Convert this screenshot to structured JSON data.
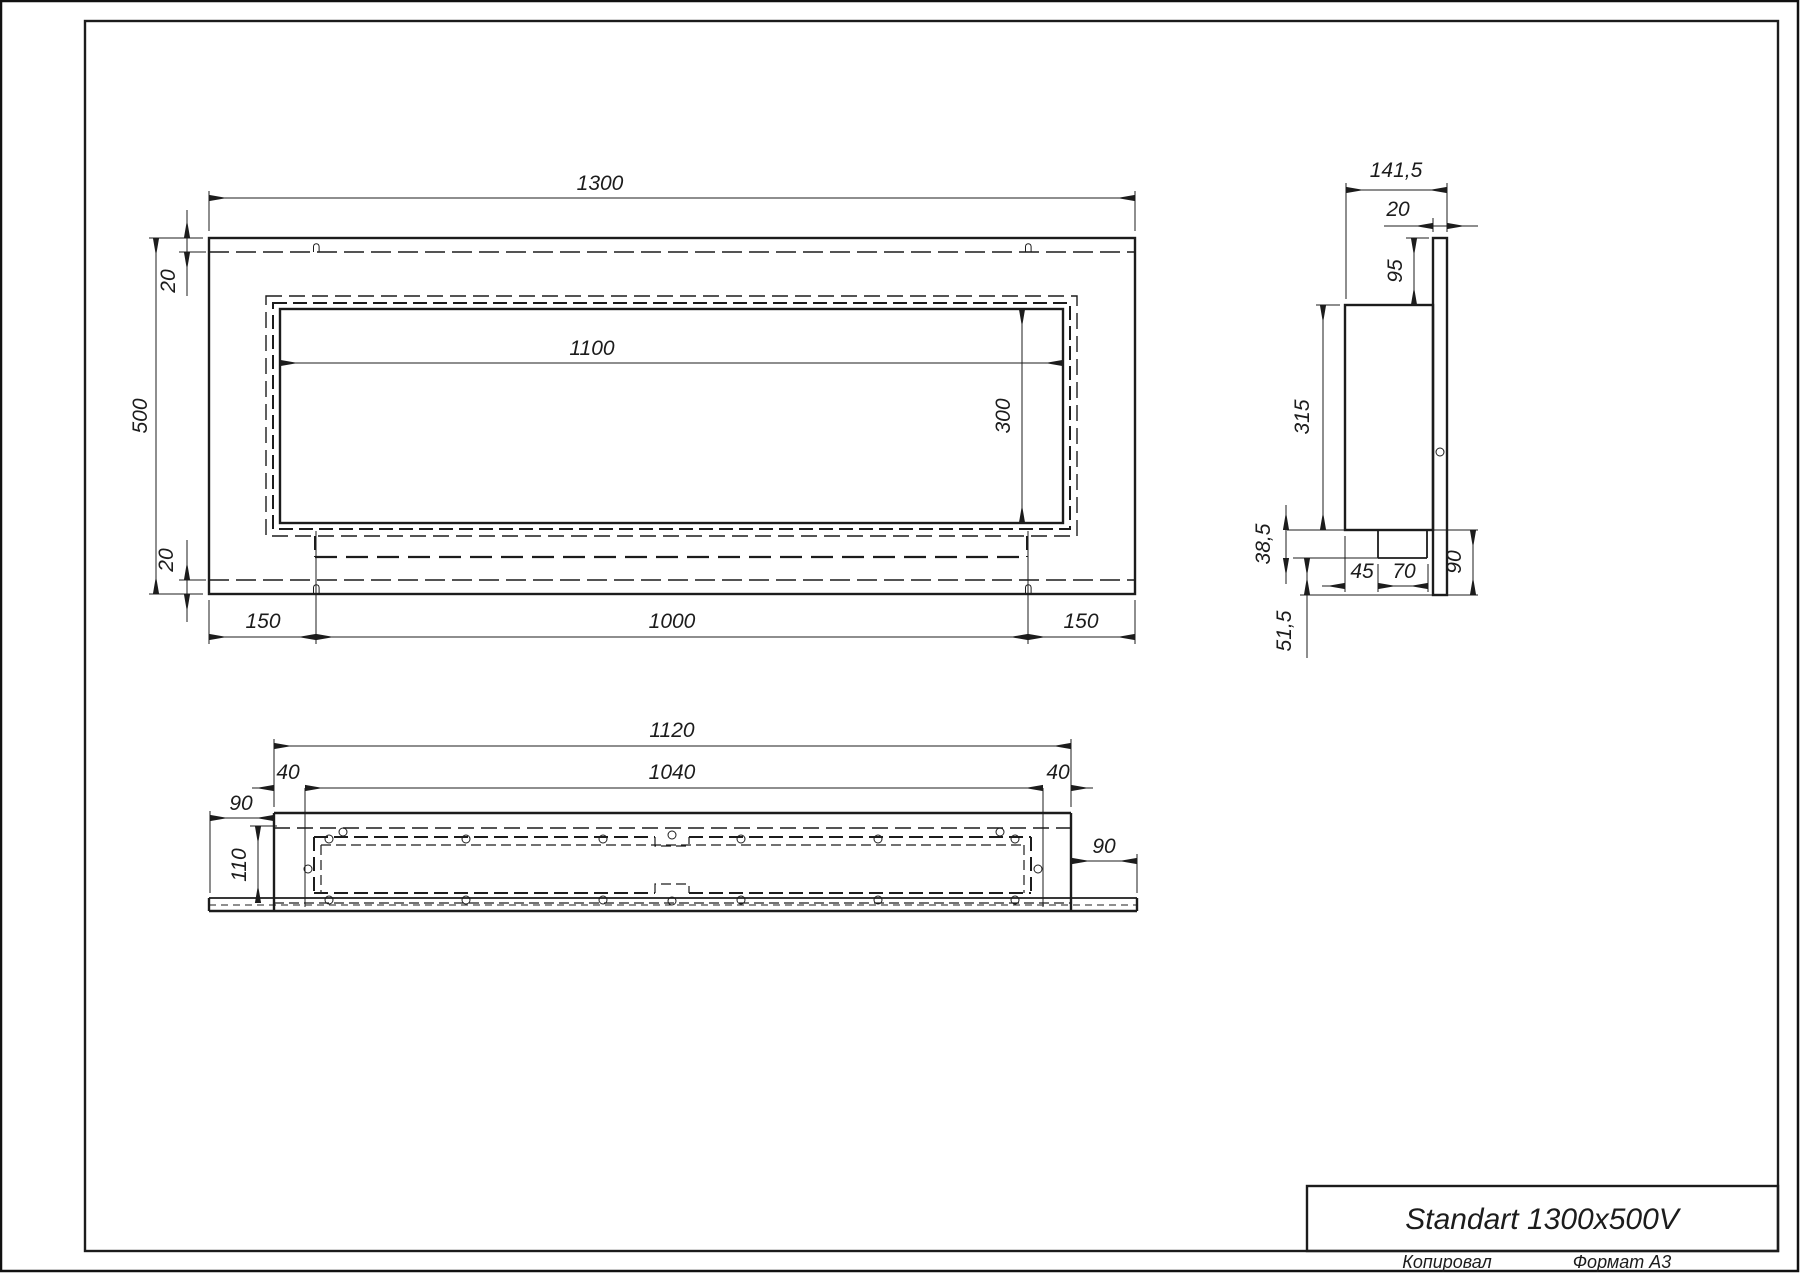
{
  "document": {
    "type": "technical-drawing",
    "product": "Standart 1300x500V",
    "sheet_format": "А3"
  },
  "title_block": {
    "title": "Standart 1300x500V",
    "footer_left": "Копировал",
    "footer_right": "Формат А3"
  },
  "views": {
    "front": {
      "label": "front-view",
      "dims": {
        "total_width": "1300",
        "total_height": "500",
        "top_inset": "20",
        "bottom_inset": "20",
        "opening_width": "1100",
        "opening_height": "300",
        "left_margin": "150",
        "box_span": "1000",
        "right_margin": "150"
      }
    },
    "side": {
      "label": "side-view",
      "dims": {
        "total_depth": "141,5",
        "panel_thickness": "20",
        "top_to_body": "95",
        "body_height": "315",
        "step_height": "38,5",
        "bottom_gap": "51,5",
        "step_offset": "45",
        "step_width": "70",
        "panel_below_body": "90"
      }
    },
    "bottom": {
      "label": "bottom-view",
      "dims": {
        "body_width": "1120",
        "inner_width": "1040",
        "wall_left": "40",
        "wall_right": "40",
        "overhang_left": "90",
        "body_depth": "110",
        "overhang_right": "90"
      }
    }
  },
  "colors": {
    "line": "#1c1c1c",
    "background": "#ffffff"
  }
}
